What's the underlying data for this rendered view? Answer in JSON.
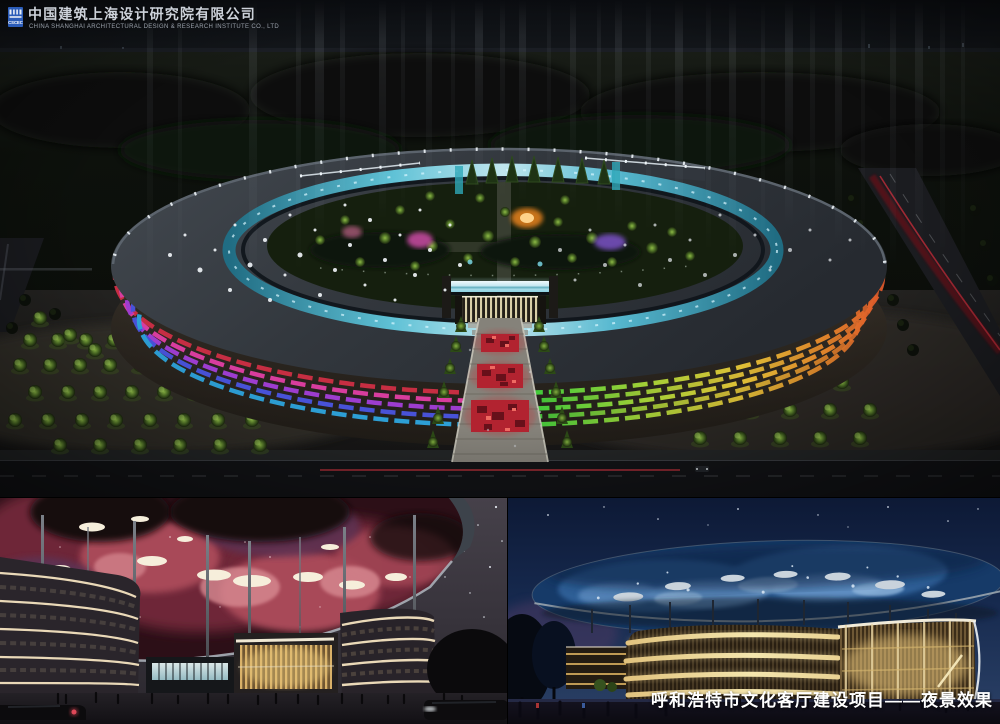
{
  "header": {
    "company_zh": "中国建筑上海设计研究院有限公司",
    "company_en": "CHINA SHANGHAI ARCHITECTURAL DESIGN & RESEARCH INSTITUTE CO., LTD",
    "logo_text": "CSCEC"
  },
  "caption": {
    "text": "呼和浩特市文化客厅建设项目——夜景效果"
  },
  "colors": {
    "facade_left_bands": [
      "#cf2f45",
      "#e23fa5",
      "#a43fd9",
      "#4a55e2",
      "#2ea6e0"
    ],
    "facade_right_stops": [
      "#3fd23c",
      "#a8d838",
      "#e8c838",
      "#e8862a",
      "#d8402a"
    ],
    "inner_ring_glow": "#62c9de",
    "walkway_red": "#b22330",
    "nebula_canopy": "#a84a58",
    "galaxy_roof_blue": "#2f5e96",
    "gold_band": "#f4e6ae",
    "caption_text": "#ffffff",
    "logo_blue": "#2b5cb8"
  }
}
